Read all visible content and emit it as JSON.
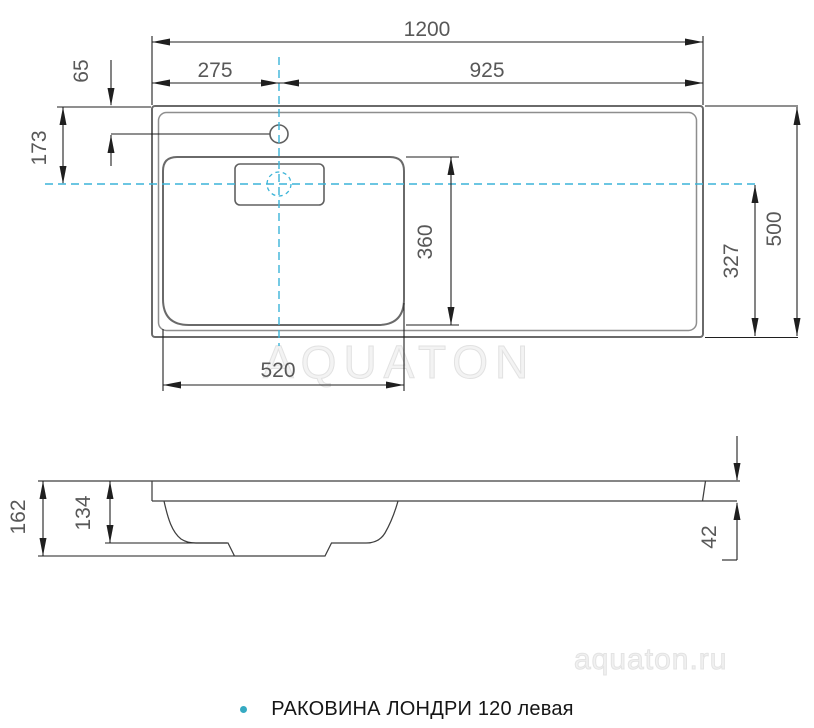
{
  "page": {
    "caption": {
      "text": "РАКОВИНА ЛОНДРИ 120 левая"
    },
    "watermarks": {
      "center": "AQUATON",
      "site": "aquaton.ru"
    },
    "colors": {
      "centerline_cyan": "#3bb4d8",
      "caption_bullet": "#35aac2",
      "drawing_gray": "#6a6a6a",
      "dimension_black": "#1f1f1f",
      "dim_text_gray": "#585858",
      "watermark_gray": "#ededed"
    }
  },
  "top_view": {
    "name": "plan view",
    "dims": {
      "overall_width_mm": "1200",
      "faucet_center_from_left_mm": "275",
      "faucet_center_to_right_mm": "925",
      "faucet_from_front_edge_mm": "65",
      "basin_axis_from_front_mm": "173",
      "basin_inner_depth_mm": "360",
      "basin_inner_width_mm": "520",
      "basin_axis_to_back_mm": "327",
      "overall_depth_mm": "500"
    }
  },
  "side_view": {
    "name": "side profile view",
    "dims": {
      "overall_height_mm": "162",
      "bowl_height_mm": "134",
      "worktop_edge_thickness_mm": "42"
    }
  }
}
